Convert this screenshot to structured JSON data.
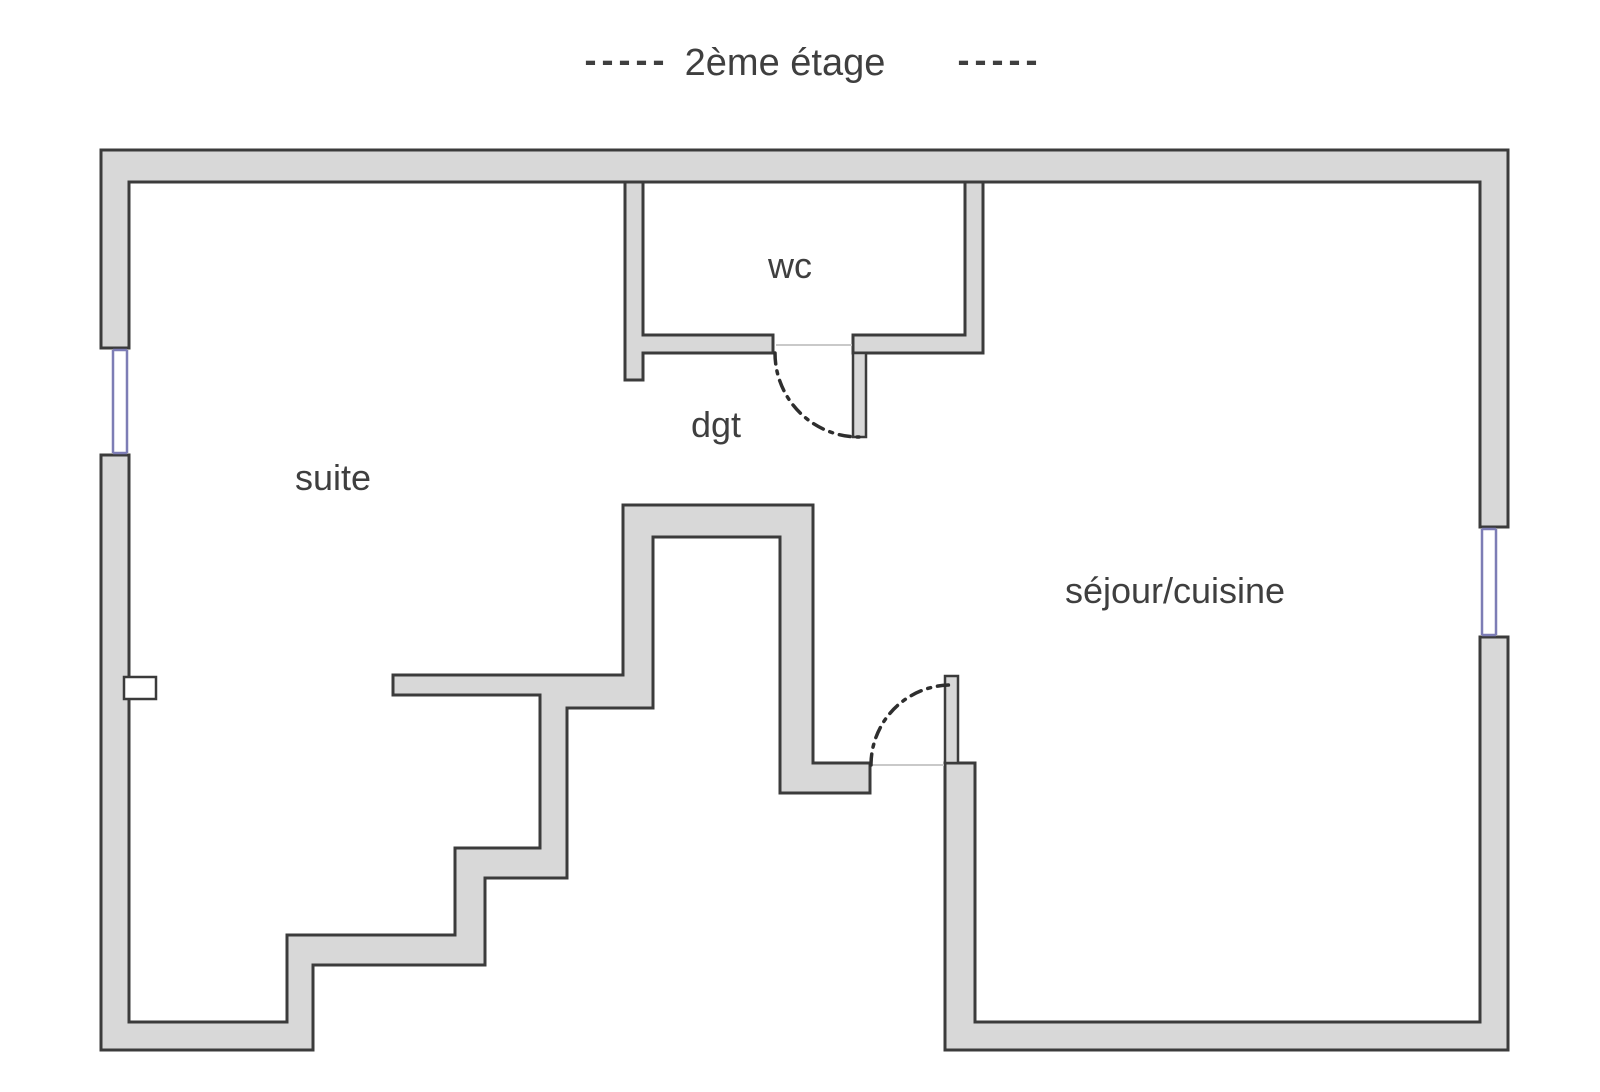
{
  "title": {
    "dashes_left": "-----",
    "text": "2ème étage",
    "dashes_right": "-----"
  },
  "rooms": {
    "wc": "wc",
    "dgt": "dgt",
    "suite": "suite",
    "sejour": "séjour/cuisine"
  },
  "colors": {
    "background": "#ffffff",
    "wall_fill": "#d8d8d8",
    "wall_stroke": "#3b3b3b",
    "window": "#7d7db5",
    "door_line": "#c9c9c9",
    "arc": "#2e2e2e",
    "text": "#3f3f3f"
  }
}
